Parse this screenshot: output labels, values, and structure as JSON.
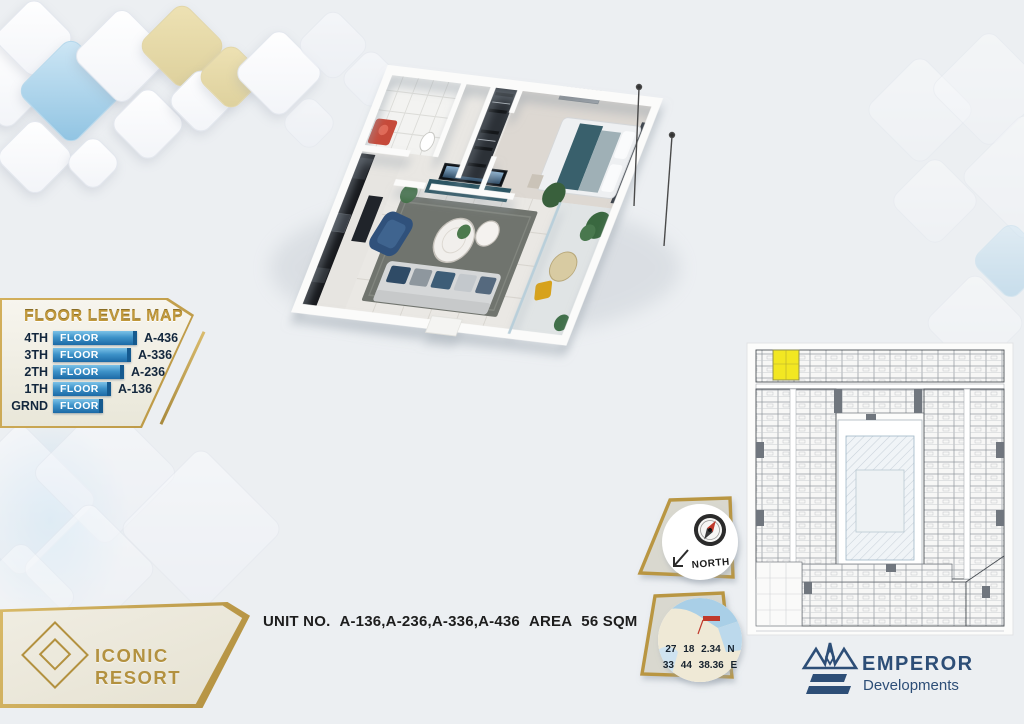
{
  "page": {
    "background": "#eceff2",
    "accent_gold": "#b99643",
    "accent_navy": "#2d4e77",
    "bar_blue_top": "#7cc2e8",
    "bar_blue_bottom": "#1c6aa6",
    "highlight_yellow": "#f2e722"
  },
  "floor_level_map": {
    "title": "FLOOR LEVEL MAP",
    "rows": [
      {
        "level": "4TH",
        "bar": "FLOOR",
        "unit": "A-436"
      },
      {
        "level": "3TH",
        "bar": "FLOOR",
        "unit": "A-336"
      },
      {
        "level": "2TH",
        "bar": "FLOOR",
        "unit": "A-236"
      },
      {
        "level": "1TH",
        "bar": "FLOOR",
        "unit": "A-136"
      },
      {
        "level": "GRND",
        "bar": "FLOOR",
        "unit": ""
      }
    ]
  },
  "unit_info": {
    "unit_label": "UNIT NO.",
    "unit_numbers": "A-136,A-236,A-336,A-436",
    "area_label": "AREA",
    "area_value": "56 SQM"
  },
  "compass": {
    "label": "NORTH"
  },
  "location": {
    "lat": "27 18 2.34 N",
    "lon": "33 44 38.36 E"
  },
  "logos": {
    "resort": "ICONIC RESORT",
    "developer_name": "EMPEROR",
    "developer_tagline": "Developments"
  }
}
